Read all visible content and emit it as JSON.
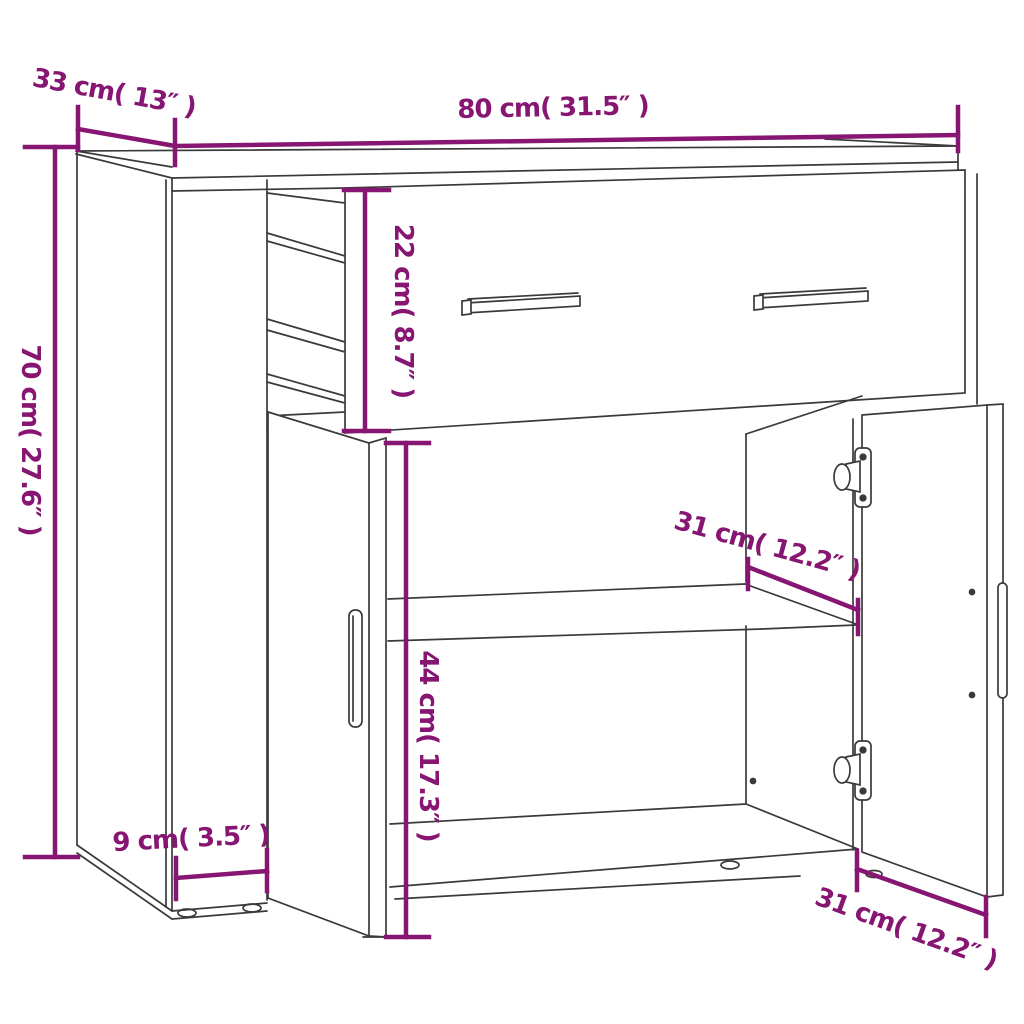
{
  "diagram": {
    "colors": {
      "accent": "#871672",
      "line_art": "#3a3a3a",
      "background": "#ffffff"
    },
    "dimensions": {
      "width": {
        "label": "80 cm( 31.5″ )",
        "cm": 80,
        "inches": 31.5
      },
      "depth": {
        "label": "33 cm( 13″ )",
        "cm": 33,
        "inches": 13
      },
      "height": {
        "label": "70 cm( 27.6″ )",
        "cm": 70,
        "inches": 27.6
      },
      "drawer_height": {
        "label": "22 cm( 8.7″ )",
        "cm": 22,
        "inches": 8.7
      },
      "door_height": {
        "label": "44 cm( 17.3″ )",
        "cm": 44,
        "inches": 17.3
      },
      "shelf_depth": {
        "label": "31 cm( 12.2″ )",
        "cm": 31,
        "inches": 12.2
      },
      "bottom_depth": {
        "label": "31 cm( 12.2″ )",
        "cm": 31,
        "inches": 12.2
      },
      "side_width": {
        "label": "9 cm( 3.5″ )",
        "cm": 9,
        "inches": 3.5
      }
    }
  }
}
